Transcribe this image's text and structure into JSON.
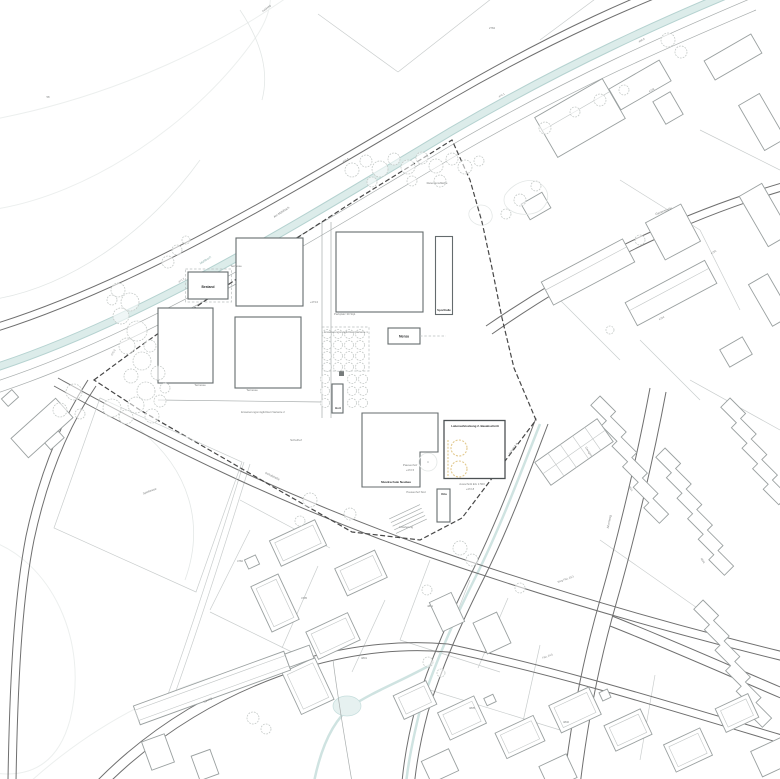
{
  "plan": {
    "kind": "architectural site plan (Lageplan) of a school campus within a residential quarter",
    "colors": {
      "background": "#ffffff",
      "stream": "#dcecea",
      "stream_edge": "#b5d2d0",
      "road": "#6f6f6f",
      "public_building": "#646b6d",
      "residential_building": "#9aa0a0",
      "parcel_line": "#c9cdcd",
      "site_boundary": "#474747",
      "tree_outline": "#c4c9c7",
      "accent_yellow": "#e2c98e",
      "label_text": "#7c7f7f",
      "label_bold": "#2f3132"
    },
    "labels": [
      {
        "t": "Bestand",
        "x": 208,
        "y": 288,
        "s": 3.3,
        "b": true
      },
      {
        "t": "Sporthalle",
        "x": 444,
        "y": 311,
        "s": 2.8,
        "b": true
      },
      {
        "t": "Mensa",
        "x": 404,
        "y": 337.5,
        "s": 3.2,
        "b": true
      },
      {
        "t": "Hort",
        "x": 338,
        "y": 409,
        "s": 2.8,
        "b": true
      },
      {
        "t": "Kita",
        "x": 444,
        "y": 495,
        "s": 2.8,
        "b": true
      },
      {
        "t": "Musikschule Neubau",
        "x": 396,
        "y": 483,
        "s": 3,
        "b": true
      },
      {
        "t": "Laboraufstockung 2. Bauabschnitt",
        "x": 475,
        "y": 427,
        "s": 2.9,
        "b": true
      },
      {
        "t": "Terrasse",
        "x": 236,
        "y": 267,
        "s": 3
      },
      {
        "t": "Terrasse",
        "x": 200,
        "y": 386,
        "s": 3
      },
      {
        "t": "Terrasse",
        "x": 252,
        "y": 391,
        "s": 3
      },
      {
        "t": "Pausenhof",
        "x": 410,
        "y": 466,
        "s": 3
      },
      {
        "t": "+472.5",
        "x": 410,
        "y": 471,
        "s": 2.7
      },
      {
        "t": "Pausenhof Süd",
        "x": 416,
        "y": 493,
        "s": 2.8
      },
      {
        "t": "Anlieferung",
        "x": 406,
        "y": 528,
        "s": 2.8
      },
      {
        "t": "Schulhof",
        "x": 296,
        "y": 441,
        "s": 3
      },
      {
        "t": "Erweiterungsmöglichkeit Variante 2",
        "x": 263,
        "y": 413,
        "s": 2.8
      },
      {
        "t": "Erweiterungsmöglichkeit Variante 1",
        "x": 346,
        "y": 333,
        "s": 2.8
      },
      {
        "t": "Parkplatz 30 Stpl.",
        "x": 345,
        "y": 315,
        "s": 2.8
      },
      {
        "t": "Spielwiese",
        "x": 150,
        "y": 492,
        "s": 3,
        "r": -20
      },
      {
        "t": "Retentionsfläche",
        "x": 437,
        "y": 184,
        "s": 2.8
      },
      {
        "t": "Garagen",
        "x": 588,
        "y": 452,
        "s": 2.8,
        "r": 57
      },
      {
        "t": "Ausschnitt EG 1:500",
        "x": 472,
        "y": 485,
        "s": 2.8
      },
      {
        "t": "+472.8",
        "x": 470,
        "y": 490,
        "s": 2.7
      },
      {
        "t": "Schnitt A-A",
        "x": 514,
        "y": 449,
        "s": 2.8,
        "r": -55
      },
      {
        "t": "Mühlbach",
        "x": 206,
        "y": 261,
        "s": 3,
        "r": -33,
        "c": "#8fb0ad"
      },
      {
        "t": "Am Mühlbach",
        "x": 282,
        "y": 213,
        "s": 3,
        "r": -33
      },
      {
        "t": "Schulstraße",
        "x": 272,
        "y": 477,
        "s": 3,
        "r": 26
      },
      {
        "t": "Gartenstraße",
        "x": 664,
        "y": 212,
        "s": 3,
        "r": -21
      },
      {
        "t": "Ahornweg",
        "x": 610,
        "y": 522,
        "s": 3,
        "r": -78
      },
      {
        "t": "Talweg",
        "x": 208,
        "y": 701,
        "s": 3,
        "r": -28
      },
      {
        "t": "Feldweg",
        "x": 267,
        "y": 9,
        "s": 2.7,
        "r": -40
      },
      {
        "t": "Weg Flst. 25/1",
        "x": 566,
        "y": 580,
        "s": 2.7,
        "r": -20
      },
      {
        "t": "Flst. 24/1",
        "x": 548,
        "y": 657,
        "s": 2.7,
        "r": -20
      },
      {
        "t": "471.2",
        "x": 182,
        "y": 281,
        "s": 2.7,
        "r": -33
      },
      {
        "t": "470.8",
        "x": 346,
        "y": 161,
        "s": 2.7,
        "r": -30
      },
      {
        "t": "470.1",
        "x": 502,
        "y": 96,
        "s": 2.7,
        "r": -30
      },
      {
        "t": "469.6",
        "x": 642,
        "y": 41,
        "s": 2.7,
        "r": -30
      },
      {
        "t": "472.3",
        "x": 114,
        "y": 353,
        "s": 2.7,
        "r": -62
      },
      {
        "t": "+473.0",
        "x": 314,
        "y": 303,
        "s": 2.7
      },
      {
        "t": "4782",
        "x": 240,
        "y": 562,
        "s": 2.7
      },
      {
        "t": "4795",
        "x": 304,
        "y": 599,
        "s": 2.7
      },
      {
        "t": "4801",
        "x": 364,
        "y": 659,
        "s": 2.7
      },
      {
        "t": "4811",
        "x": 430,
        "y": 607,
        "s": 2.7
      },
      {
        "t": "4764",
        "x": 662,
        "y": 319,
        "s": 2.7,
        "r": -30
      },
      {
        "t": "4755",
        "x": 714,
        "y": 253,
        "s": 2.7,
        "r": -30
      },
      {
        "t": "4748",
        "x": 652,
        "y": 91,
        "s": 2.7,
        "r": -30
      },
      {
        "t": "4821",
        "x": 630,
        "y": 489,
        "s": 2.7,
        "r": 57
      },
      {
        "t": "4833",
        "x": 702,
        "y": 561,
        "s": 2.7,
        "r": 57
      },
      {
        "t": "4835",
        "x": 472,
        "y": 709,
        "s": 2.7
      },
      {
        "t": "4840",
        "x": 566,
        "y": 723,
        "s": 2.7
      },
      {
        "t": "2784",
        "x": 492,
        "y": 29,
        "s": 2.7
      },
      {
        "t": "58",
        "x": 48,
        "y": 98,
        "s": 2.7
      }
    ],
    "trees": [
      [
        118,
        290,
        7
      ],
      [
        130,
        302,
        9
      ],
      [
        121,
        316,
        8
      ],
      [
        137,
        331,
        10
      ],
      [
        127,
        346,
        8
      ],
      [
        142,
        361,
        9
      ],
      [
        131,
        376,
        7
      ],
      [
        146,
        391,
        9
      ],
      [
        136,
        405,
        8
      ],
      [
        152,
        416,
        7
      ],
      [
        160,
        401,
        6
      ],
      [
        112,
        300,
        5
      ],
      [
        150,
        346,
        6
      ],
      [
        158,
        373,
        7
      ],
      [
        165,
        388,
        5
      ],
      [
        112,
        408,
        9
      ],
      [
        126,
        417,
        7
      ],
      [
        74,
        392,
        8
      ],
      [
        60,
        410,
        7
      ],
      [
        80,
        414,
        5
      ],
      [
        168,
        262,
        6
      ],
      [
        177,
        250,
        5
      ],
      [
        186,
        240,
        4
      ],
      [
        352,
        170,
        7
      ],
      [
        366,
        161,
        6
      ],
      [
        380,
        169,
        8
      ],
      [
        394,
        159,
        6
      ],
      [
        408,
        167,
        7
      ],
      [
        422,
        158,
        6
      ],
      [
        436,
        166,
        7
      ],
      [
        452,
        159,
        6
      ],
      [
        465,
        167,
        7
      ],
      [
        479,
        161,
        5
      ],
      [
        412,
        181,
        5
      ],
      [
        440,
        181,
        6
      ],
      [
        372,
        182,
        5
      ],
      [
        545,
        128,
        6
      ],
      [
        575,
        112,
        5
      ],
      [
        600,
        100,
        6
      ],
      [
        624,
        90,
        5
      ],
      [
        668,
        40,
        7
      ],
      [
        681,
        52,
        6
      ],
      [
        520,
        200,
        6
      ],
      [
        506,
        214,
        5
      ],
      [
        536,
        186,
        5
      ],
      [
        310,
        500,
        7
      ],
      [
        350,
        514,
        6
      ],
      [
        300,
        521,
        5
      ],
      [
        460,
        548,
        7
      ],
      [
        472,
        560,
        6
      ],
      [
        520,
        588,
        5
      ],
      [
        427,
        590,
        5
      ],
      [
        253,
        718,
        6
      ],
      [
        266,
        729,
        5
      ],
      [
        428,
        662,
        5
      ],
      [
        441,
        673,
        4
      ],
      [
        640,
        240,
        5
      ],
      [
        610,
        330,
        4
      ],
      [
        327,
        334,
        4.5
      ],
      [
        338,
        334,
        4.5
      ],
      [
        349,
        334,
        4.5
      ],
      [
        360,
        334,
        4.5
      ],
      [
        327,
        345,
        4.5
      ],
      [
        338,
        345,
        4.5
      ],
      [
        349,
        345,
        4.5
      ],
      [
        360,
        345,
        4.5
      ],
      [
        327,
        356,
        4.5
      ],
      [
        338,
        356,
        4.5
      ],
      [
        349,
        356,
        4.5
      ],
      [
        360,
        356,
        4.5
      ],
      [
        327,
        367,
        4.5
      ],
      [
        338,
        367,
        4.5
      ],
      [
        349,
        367,
        4.5
      ],
      [
        360,
        367,
        4.5
      ],
      [
        325,
        379,
        4.5
      ],
      [
        352,
        379,
        4.5
      ],
      [
        363,
        379,
        4.5
      ],
      [
        325,
        391,
        4.5
      ],
      [
        352,
        391,
        4.5
      ],
      [
        363,
        391,
        4.5
      ],
      [
        325,
        403,
        4.5
      ],
      [
        352,
        403,
        4.5
      ],
      [
        363,
        403,
        4.5
      ]
    ],
    "yellow_markers": {
      "circles": [
        [
          459,
          448,
          8
        ],
        [
          459,
          469,
          8
        ]
      ],
      "line": [
        448,
        440,
        448,
        478
      ]
    }
  }
}
